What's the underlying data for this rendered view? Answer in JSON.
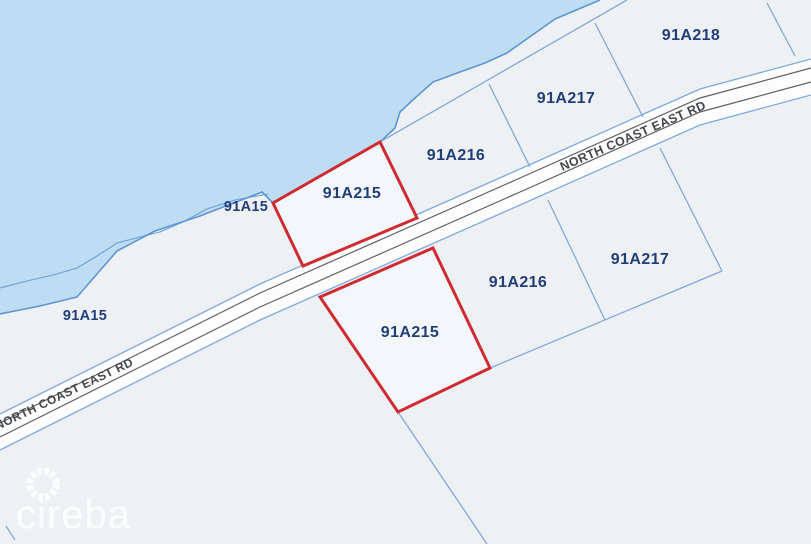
{
  "map": {
    "parcel_labels": {
      "a215": "91A215",
      "a216": "91A216",
      "a217": "91A217",
      "a218": "91A218",
      "a15": "91A15"
    },
    "road_name": "NORTH COAST EAST RD",
    "watermark": "cireba",
    "colors": {
      "water": "#bedcf2",
      "land": "#eef1f4",
      "boundary_blue": "#7fa9dc",
      "coastline_blue": "#5e96d2",
      "road_surface": "#fdfdfe",
      "road_outline": "#5d6064",
      "highlight_red": "#ce2b32",
      "parcel_label_navy": "#223e78",
      "road_label_gray": "#43464b",
      "watermark_white": "#ffffff"
    }
  }
}
